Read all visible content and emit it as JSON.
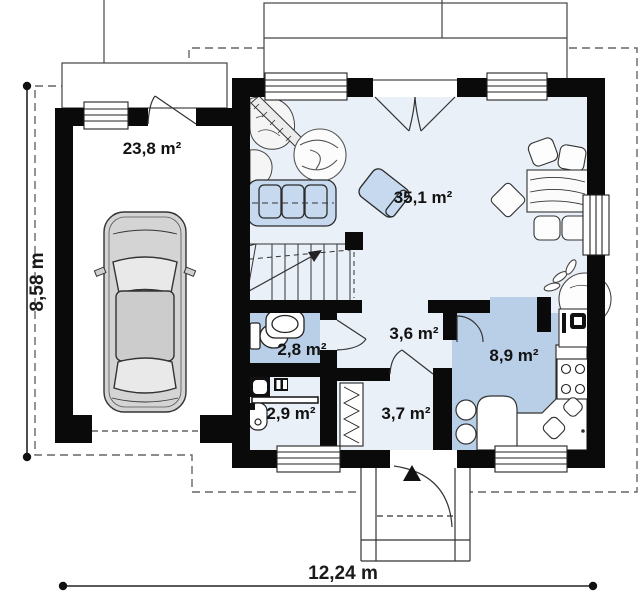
{
  "plan": {
    "type": "house-floor-plan",
    "rooms": [
      {
        "id": "garage",
        "area": "23,8 m²"
      },
      {
        "id": "living-room",
        "area": "35,1 m²"
      },
      {
        "id": "bathroom",
        "area": "2,8 m²"
      },
      {
        "id": "hall",
        "area": "3,6 m²"
      },
      {
        "id": "kitchen",
        "area": "8,9 m²"
      },
      {
        "id": "utility",
        "area": "2,9 m²"
      },
      {
        "id": "entry",
        "area": "3,7 m²"
      }
    ],
    "dimensions": {
      "overall_width": "12,24 m",
      "overall_depth": "8,58 m"
    },
    "colors": {
      "wall": "#0a0a0a",
      "room_highlight": "#b9cfe8",
      "room_light": "#eaf0f8",
      "furniture_blue": "#c7d9ee",
      "car_body": "#d4d4d4",
      "dash_line": "#666666"
    }
  }
}
